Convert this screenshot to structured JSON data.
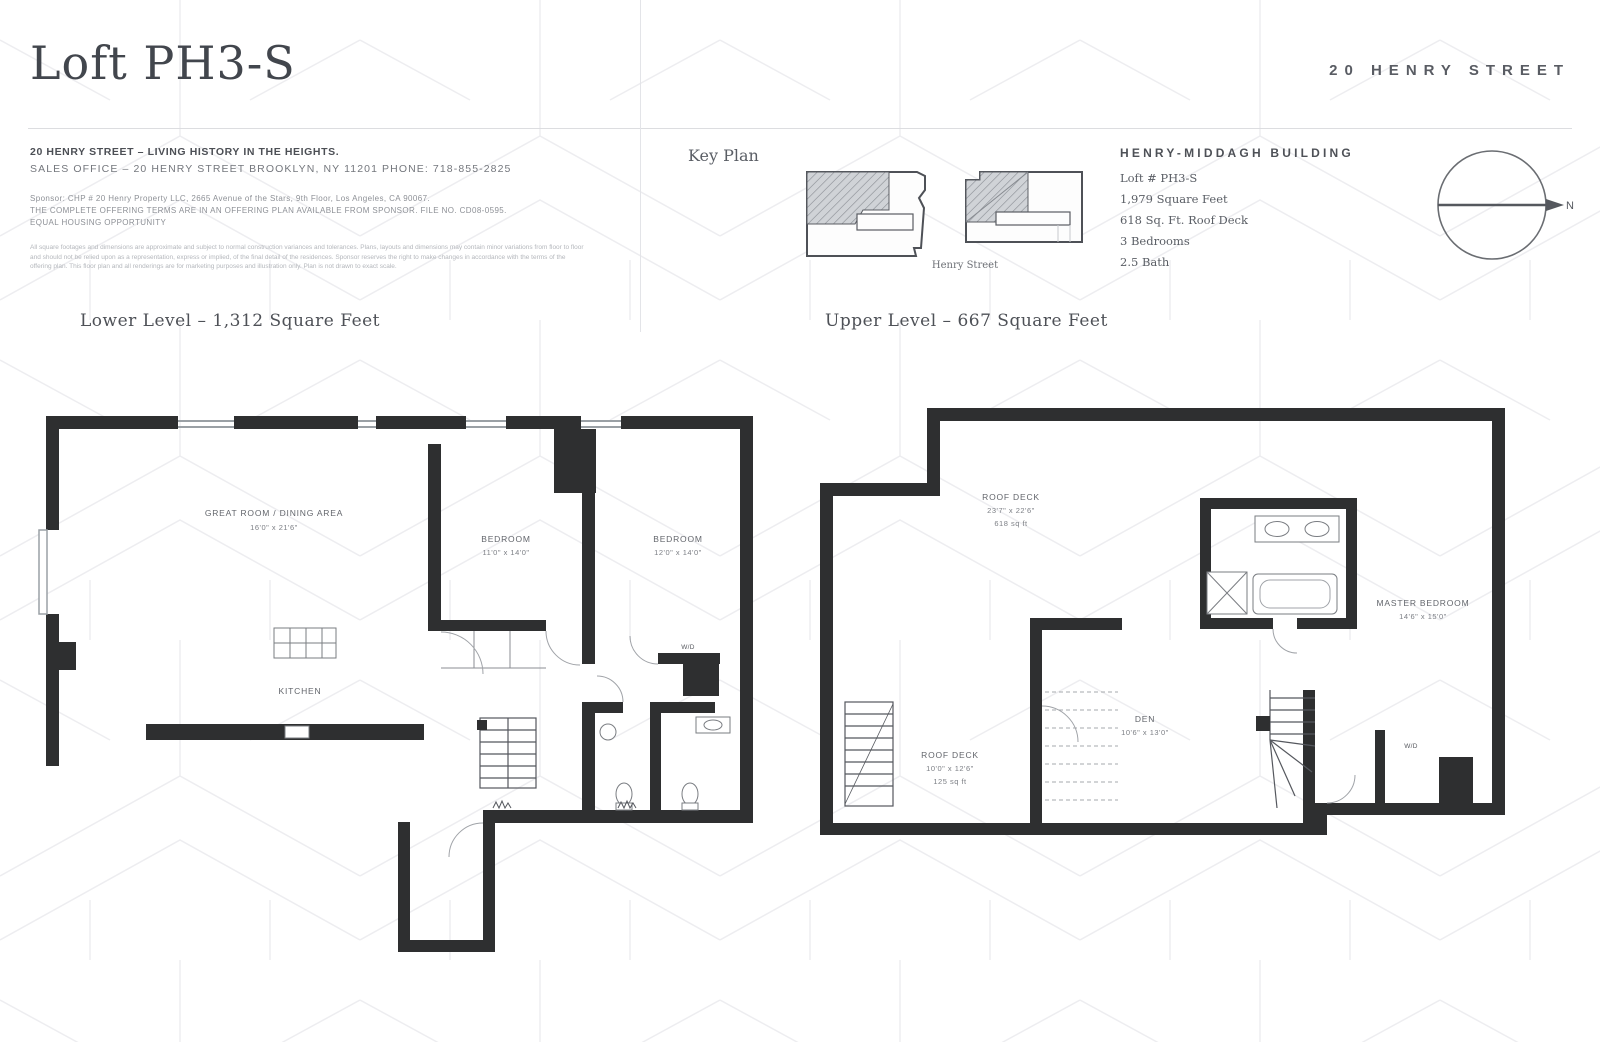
{
  "header": {
    "title": "Loft PH3-S",
    "building_name": "20 HENRY STREET"
  },
  "info_block": {
    "headline": "20 HENRY STREET – LIVING HISTORY IN THE HEIGHTS.",
    "sales_line": "SALES OFFICE – 20 HENRY STREET  BROOKLYN, NY 11201  PHONE: 718-855-2825",
    "sponsor_line1": "Sponsor: CHP # 20 Henry Property LLC, 2665 Avenue of the Stars, 9th Floor, Los Angeles, CA 90067.",
    "sponsor_line2": "THE COMPLETE OFFERING TERMS ARE IN AN OFFERING PLAN AVAILABLE FROM SPONSOR. FILE NO. CD08-0595.",
    "sponsor_line3": "EQUAL HOUSING OPPORTUNITY",
    "disclaimer_line1": "All square footages and dimensions are approximate and subject to normal construction variances and tolerances. Plans, layouts and dimensions may contain minor variations from floor to floor",
    "disclaimer_line2": "and should not be relied upon as a representation, express or implied, of the final detail of the residences. Sponsor reserves the right to make changes in accordance with the terms of the",
    "disclaimer_line3": "offering plan. This floor plan and all renderings are for marketing purposes and illustration only. Plan is not drawn to exact scale."
  },
  "key_plan": {
    "label": "Key Plan",
    "street_label": "Henry Street"
  },
  "building_info": {
    "name": "HENRY-MIDDAGH BUILDING",
    "lines": [
      "Loft # PH3-S",
      "1,979 Square Feet",
      "618 Sq. Ft. Roof Deck",
      "3 Bedrooms",
      "2.5 Bath"
    ]
  },
  "compass": {
    "north_label": "N"
  },
  "lower_level": {
    "heading": "Lower Level – 1,312 Square Feet",
    "rooms": {
      "great_room_name": "GREAT ROOM / DINING AREA",
      "great_room_dims": "16'0\" x 21'6\"",
      "kitchen_name": "KITCHEN",
      "bedroom2_name": "BEDROOM",
      "bedroom2_dims": "11'0\" x 14'0\"",
      "bedroom3_name": "BEDROOM",
      "bedroom3_dims": "12'0\" x 14'0\"",
      "wd_label": "W/D"
    }
  },
  "upper_level": {
    "heading": "Upper Level – 667 Square Feet",
    "rooms": {
      "roof_deck_name": "ROOF DECK",
      "roof_deck_dims": "23'7\" x 22'6\"",
      "roof_deck_area": "618 sq ft",
      "setback_deck_name": "ROOF DECK",
      "setback_deck_dims": "10'0\" x 12'6\"",
      "setback_deck_area": "125 sq ft",
      "den_name": "DEN",
      "den_dims": "10'6\" x 13'0\"",
      "master_name": "MASTER BEDROOM",
      "master_dims": "14'6\" x 15'0\"",
      "wd_label": "W/D"
    }
  },
  "colors": {
    "ink": "#42464d",
    "wall": "#2e2f30",
    "hatch_fill": "#d0d3d7",
    "pattern_line": "#ededf0"
  }
}
